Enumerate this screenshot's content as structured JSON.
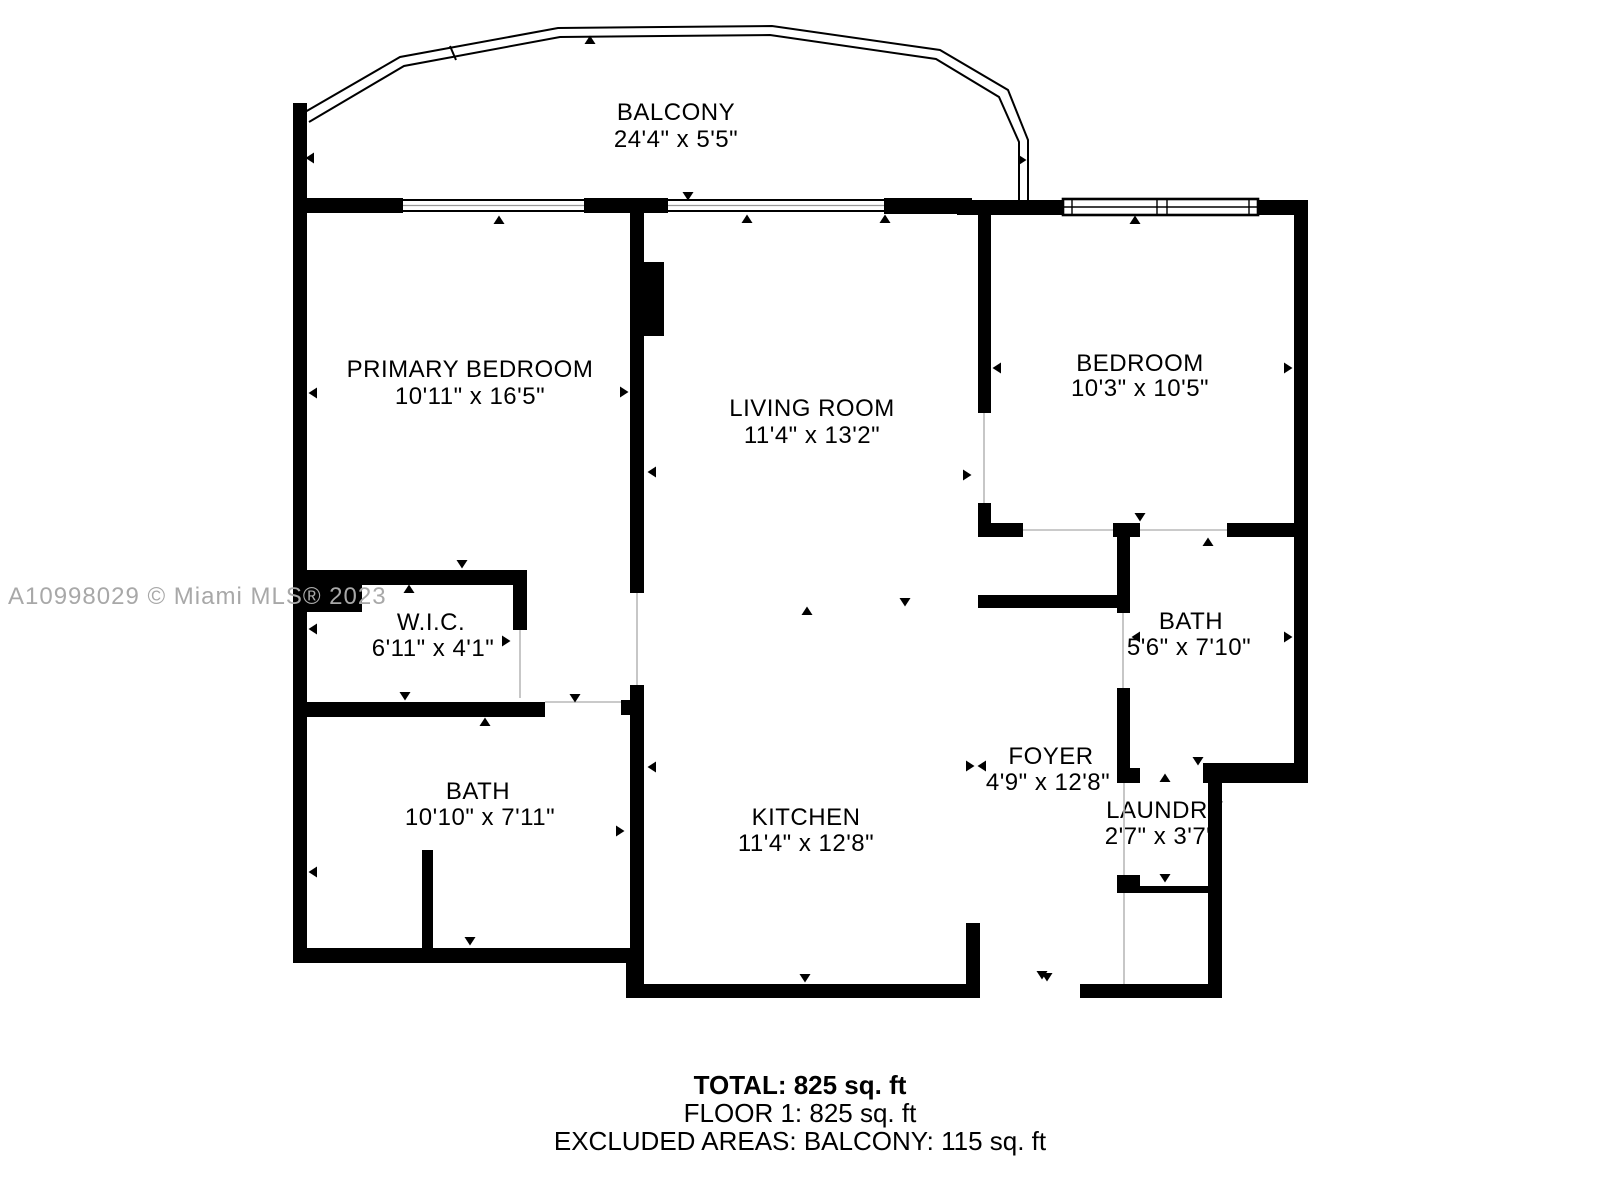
{
  "watermark": "A10998029 © Miami MLS® 2023",
  "rooms": {
    "balcony": {
      "name": "BALCONY",
      "dims": "24'4\" x 5'5\""
    },
    "primary_bedroom": {
      "name": "PRIMARY BEDROOM",
      "dims": "10'11\" x 16'5\""
    },
    "living_room": {
      "name": "LIVING ROOM",
      "dims": "11'4\" x 13'2\""
    },
    "bedroom": {
      "name": "BEDROOM",
      "dims": "10'3\" x 10'5\""
    },
    "wic": {
      "name": "W.I.C.",
      "dims": "6'11\" x 4'1\""
    },
    "bath_primary": {
      "name": "BATH",
      "dims": "10'10\" x 7'11\""
    },
    "kitchen": {
      "name": "KITCHEN",
      "dims": "11'4\" x 12'8\""
    },
    "foyer": {
      "name": "FOYER",
      "dims": "4'9\" x 12'8\""
    },
    "bath_second": {
      "name": "BATH",
      "dims": "5'6\" x 7'10\""
    },
    "laundry": {
      "name": "LAUNDRY",
      "dims": "2'7\" x 3'7\""
    }
  },
  "summary": {
    "total": "TOTAL: 825 sq. ft",
    "floor1": "FLOOR 1: 825 sq. ft",
    "excluded": "EXCLUDED AREAS: BALCONY: 115 sq. ft"
  },
  "colors": {
    "wall": "#000000",
    "background": "#ffffff",
    "watermark_gray": "#a8a8a8"
  }
}
